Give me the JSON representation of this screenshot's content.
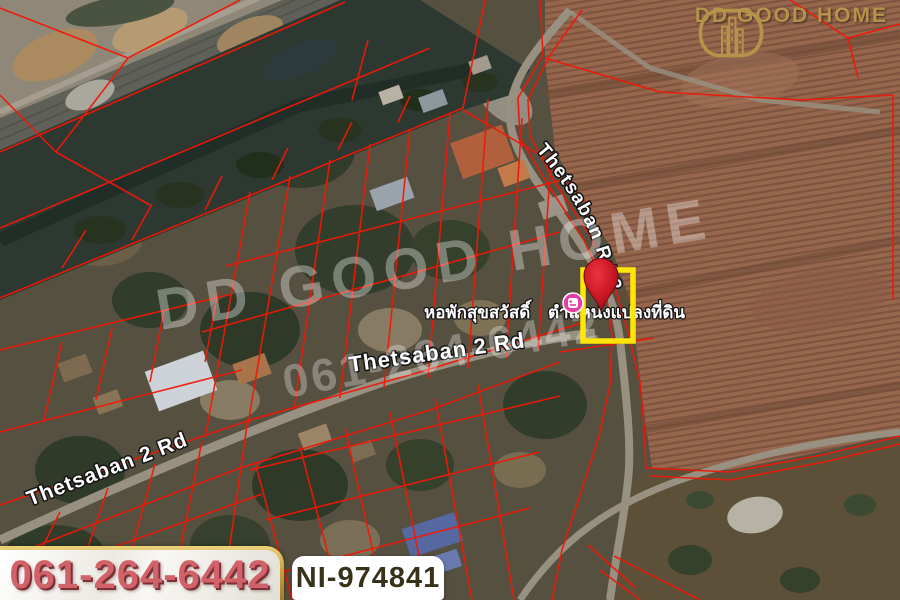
{
  "branding": {
    "logo_text": "DD GOOD HOME"
  },
  "watermark": {
    "title": "DD GOOD HOME",
    "phone": "061-264-6442"
  },
  "map_labels": {
    "road_curved": "Thetsaban Rd 2",
    "road_center": "Thetsaban 2 Rd",
    "road_southwest": "Thetsaban 2 Rd",
    "place": "หอพักสุขสวัสดิ์",
    "pin": "ตำแหน่งแปลงที่ดิน"
  },
  "colors": {
    "parcel_line": "#f01808",
    "highlight_parcel": "#ffe607",
    "pin": "#c41622",
    "lodging_icon": "#e23ea4",
    "logo_gold": "#b5934a",
    "phone_text": "#d2626a"
  },
  "footer": {
    "phone": "061-264-6442",
    "listing_id": "NI-974841"
  }
}
